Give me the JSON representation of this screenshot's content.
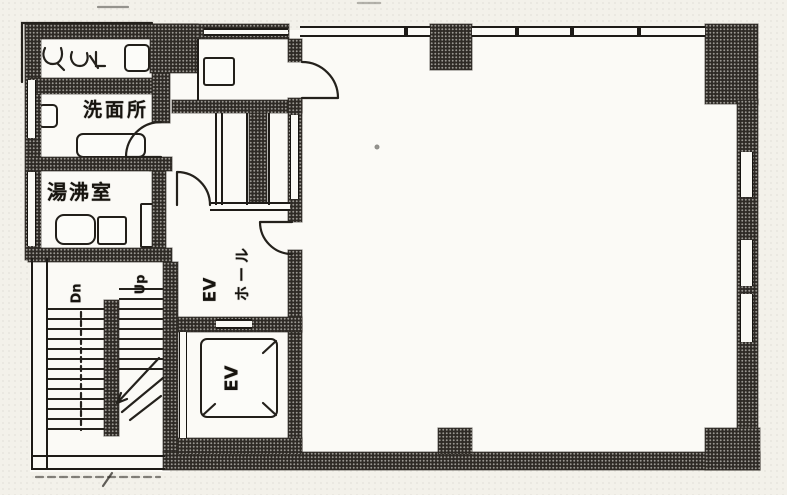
{
  "document": {
    "type": "scanned architectural floor plan (office building, single storey)",
    "language": "ja"
  },
  "rooms": {
    "washroom": {
      "label": "洗面所"
    },
    "kitchenette": {
      "label": "湯沸室"
    },
    "elevator_hall": {
      "label_ev": "EV",
      "label_hall": "ホール"
    },
    "elevator": {
      "label": "EV"
    },
    "stairs": {
      "down_label": "Dn",
      "up_label": "Up"
    }
  },
  "colors": {
    "wall_fill": "#2e2a25",
    "line": "#1e1b17",
    "paper": "#f3f1ea",
    "interior": "#fbfaf6"
  }
}
